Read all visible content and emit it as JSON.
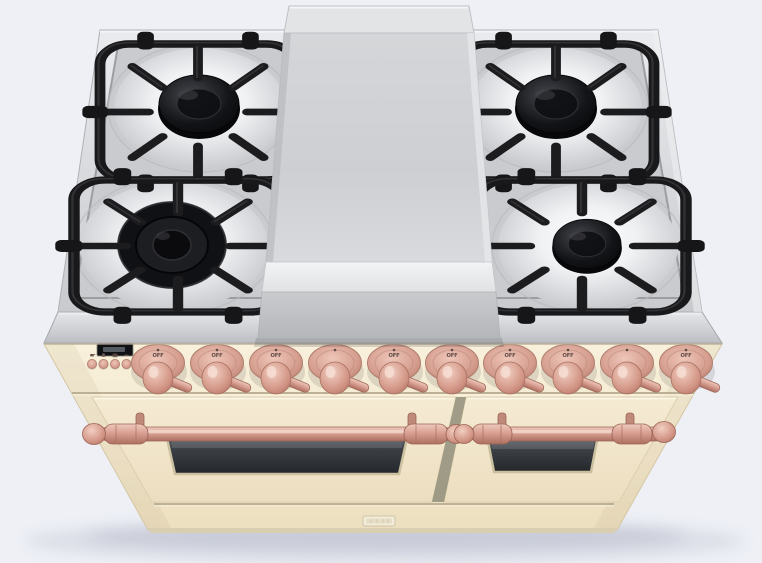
{
  "image": {
    "type": "3d-product-render",
    "subject": "Freestanding dual-fuel range cooker with center griddle, viewed from front-above",
    "background_color": "#eef0f6"
  },
  "range": {
    "finish": {
      "body_color": "#f5ecd5",
      "body_color_name": "antique cream",
      "trim_color": "#d8a193",
      "trim_color_name": "copper",
      "steel_color": "#d6d8db",
      "grate_color": "#1b1b1d"
    },
    "cooktop": {
      "rim": "stainless steel frame",
      "griddle": "stainless steel center griddle",
      "grates": "black cast-iron grates",
      "burners": [
        {
          "id": "back-left",
          "desc": "single-ring burner with black cap"
        },
        {
          "id": "front-left",
          "desc": "double-ring wok burner"
        },
        {
          "id": "back-right",
          "desc": "single-ring burner with black cap"
        },
        {
          "id": "front-right",
          "desc": "single-ring burner with black cap"
        }
      ]
    },
    "control_panel": {
      "display": {
        "value": ""
      },
      "buttons": [
        {
          "icon": "pot-icon"
        },
        {
          "icon": "bell-icon"
        },
        {
          "icon": "auto-icon"
        },
        {
          "icon": "minus-icon"
        },
        {
          "icon": "plus-icon"
        }
      ],
      "knobs": [
        {
          "label": "OFF"
        },
        {
          "label": "OFF"
        },
        {
          "label": "OFF"
        },
        {
          "label": ""
        },
        {
          "label": "OFF"
        },
        {
          "label": "OFF"
        },
        {
          "label": "OFF"
        },
        {
          "label": "OFF"
        },
        {
          "label": ""
        },
        {
          "label": "OFF"
        }
      ]
    },
    "ovens": {
      "left_door": {
        "desc": "wide oven door with glass window and copper rail handle"
      },
      "right_door": {
        "desc": "narrow oven door with glass window and copper rail handle"
      },
      "kick_panel": {
        "badge_text": ""
      }
    }
  }
}
